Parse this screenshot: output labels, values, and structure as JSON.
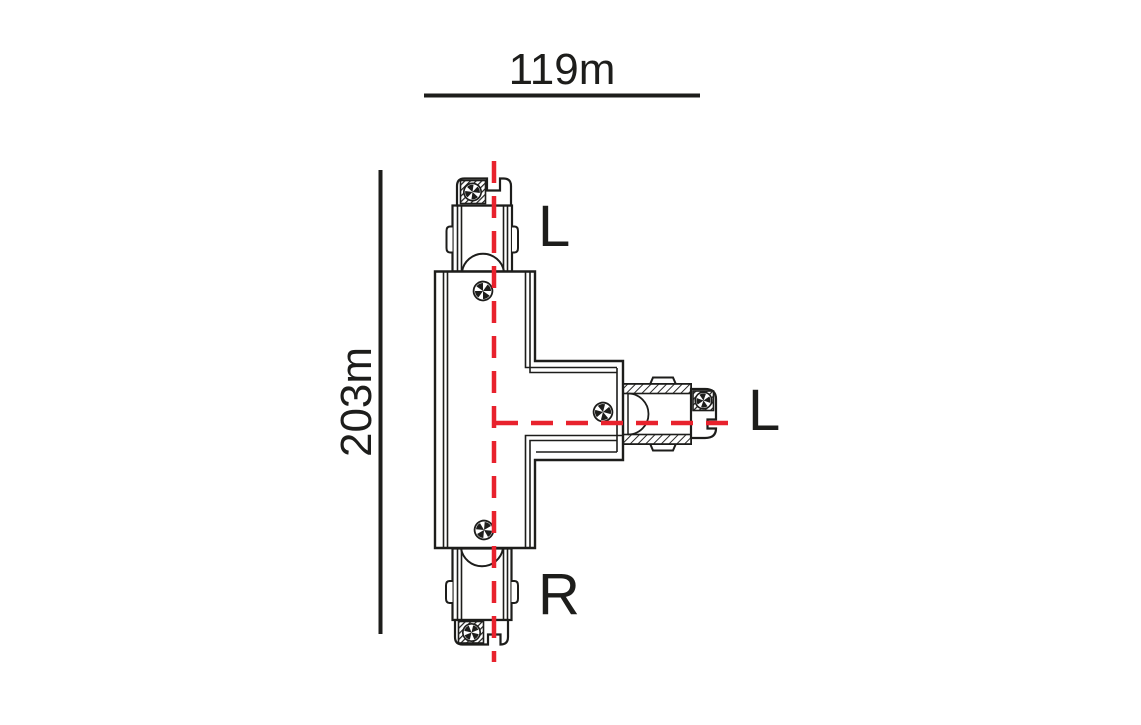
{
  "diagram": {
    "dimensions": {
      "width": "119m",
      "height": "203m"
    },
    "labels": {
      "top": "L",
      "right": "L",
      "bottom": "R"
    },
    "colors": {
      "line": "#1d1d1b",
      "centerline": "#e8222d",
      "background": "#ffffff"
    }
  }
}
